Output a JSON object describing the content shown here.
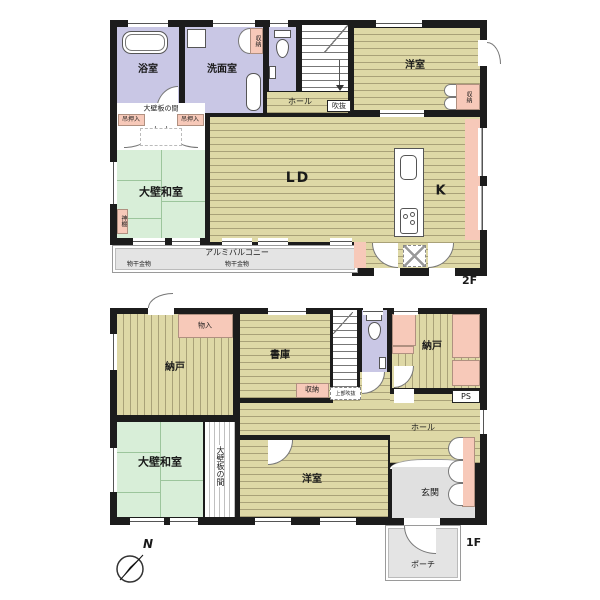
{
  "colors": {
    "wall": "#1c1c1c",
    "wood_floor": "#ded8a6",
    "wood_stripe": "#a9a178",
    "tatami_green": "#d8eed8",
    "wet_room_lavender": "#c9c7e5",
    "closet_pink": "#f7c9b9",
    "exterior_gray": "#e4e4e4"
  },
  "floor2": {
    "floor_label": "2F",
    "bathroom": "浴室",
    "washroom": "洗面室",
    "washroom_closet": "収納",
    "hall": "ホール",
    "void_label": "吹抜",
    "western_room": "洋室",
    "western_room_closet": "収納",
    "alcove": "大壁板の間",
    "hanging_closet_left": "吊押入",
    "hanging_closet_right": "吊押入",
    "japanese_room": "大壁和室",
    "kamidana": "神棚",
    "living_dining": "LD",
    "kitchen": "K",
    "balcony": "アルミバルコニー",
    "drying_fixture_left": "物干金物",
    "drying_fixture_right": "物干金物"
  },
  "floor1": {
    "floor_label": "1F",
    "storage_left": "納戸",
    "closet_top": "物入",
    "library": "書庫",
    "stair_closet": "収納",
    "void_above": "上部吹抜",
    "storage_right": "納戸",
    "pipe_space": "PS",
    "hall": "ホール",
    "japanese_room": "大壁和室",
    "alcove": "大壁板の間",
    "western_room": "洋室",
    "entrance": "玄関",
    "porch": "ポーチ"
  },
  "compass": {
    "north": "N"
  }
}
